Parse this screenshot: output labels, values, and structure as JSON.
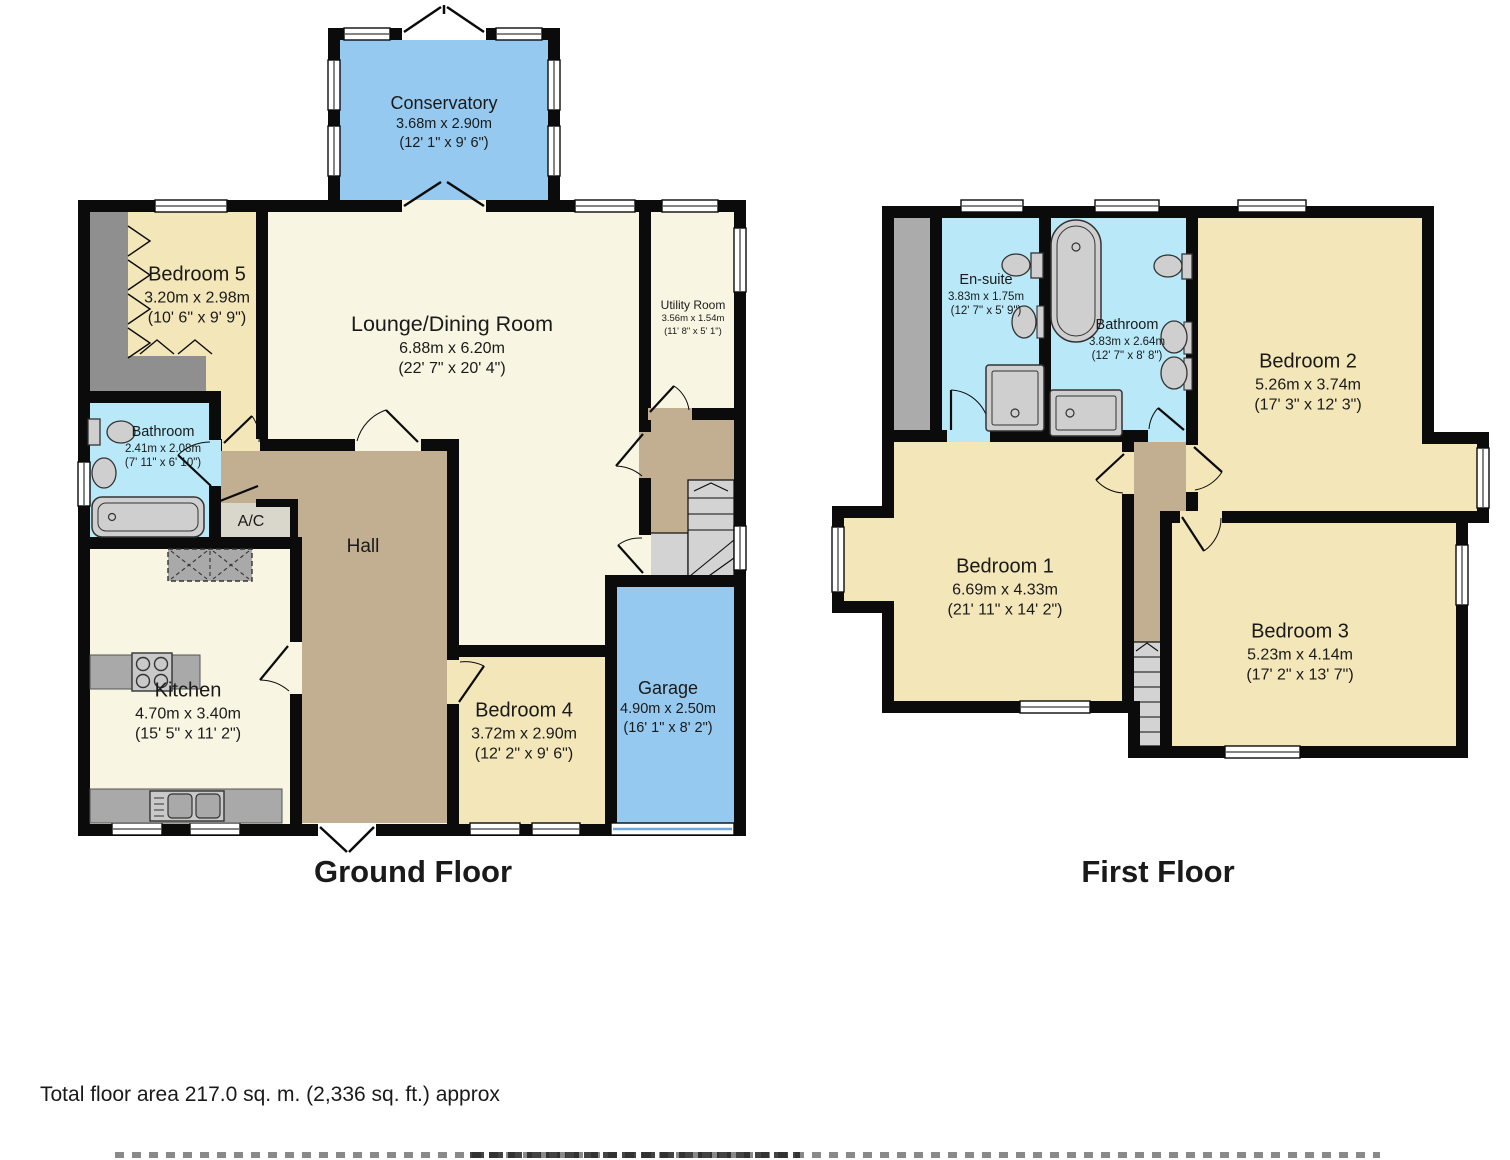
{
  "floors": {
    "ground": {
      "label": "Ground Floor",
      "rooms": {
        "conservatory": {
          "name": "Conservatory",
          "metric": "3.68m x 2.90m",
          "imperial": "(12' 1\" x 9' 6\")"
        },
        "bedroom5": {
          "name": "Bedroom 5",
          "metric": "3.20m x 2.98m",
          "imperial": "(10' 6\" x 9' 9\")"
        },
        "lounge": {
          "name": "Lounge/Dining Room",
          "metric": "6.88m x 6.20m",
          "imperial": "(22' 7\" x 20' 4\")"
        },
        "utility": {
          "name": "Utility Room",
          "metric": "3.56m x 1.54m",
          "imperial": "(11' 8\" x 5' 1\")"
        },
        "bathroom": {
          "name": "Bathroom",
          "metric": "2.41m x 2.08m",
          "imperial": "(7' 11\" x 6' 10\")"
        },
        "ac": {
          "name": "A/C"
        },
        "hall": {
          "name": "Hall"
        },
        "kitchen": {
          "name": "Kitchen",
          "metric": "4.70m x 3.40m",
          "imperial": "(15' 5\" x 11' 2\")"
        },
        "bedroom4": {
          "name": "Bedroom 4",
          "metric": "3.72m x 2.90m",
          "imperial": "(12' 2\" x 9' 6\")"
        },
        "garage": {
          "name": "Garage",
          "metric": "4.90m x 2.50m",
          "imperial": "(16' 1\" x 8' 2\")"
        }
      }
    },
    "first": {
      "label": "First Floor",
      "rooms": {
        "ensuite": {
          "name": "En-suite",
          "metric": "3.83m x 1.75m",
          "imperial": "(12' 7\" x 5' 9\")"
        },
        "bathroom": {
          "name": "Bathroom",
          "metric": "3.83m x 2.64m",
          "imperial": "(12' 7\" x 8' 8\")"
        },
        "bedroom2": {
          "name": "Bedroom 2",
          "metric": "5.26m x 3.74m",
          "imperial": "(17' 3\" x 12' 3\")"
        },
        "bedroom1": {
          "name": "Bedroom 1",
          "metric": "6.69m x 4.33m",
          "imperial": "(21' 11\" x 14' 2\")"
        },
        "bedroom3": {
          "name": "Bedroom 3",
          "metric": "5.23m x 4.14m",
          "imperial": "(17' 2\" x 13' 7\")"
        }
      }
    }
  },
  "footer": {
    "total_area": "Total floor area 217.0 sq. m. (2,336 sq. ft.) approx"
  },
  "palette": {
    "wall_black": "#0b0b0b",
    "room_cream": "#f8f5e3",
    "room_tan": "#f3e6b8",
    "conservatory_garage_blue": "#95c9f0",
    "bathroom_cyan": "#b9e9f8",
    "hall_brown": "#c2af92",
    "wardrobe_gray": "#8f8f8f",
    "stairs_gray": "#d3d3d3",
    "fixture_gray": "#cfcfcf",
    "void_gray": "#ababab",
    "ac_gray": "#d9d6cb",
    "garage_door_blue": "#6fa8dc"
  }
}
